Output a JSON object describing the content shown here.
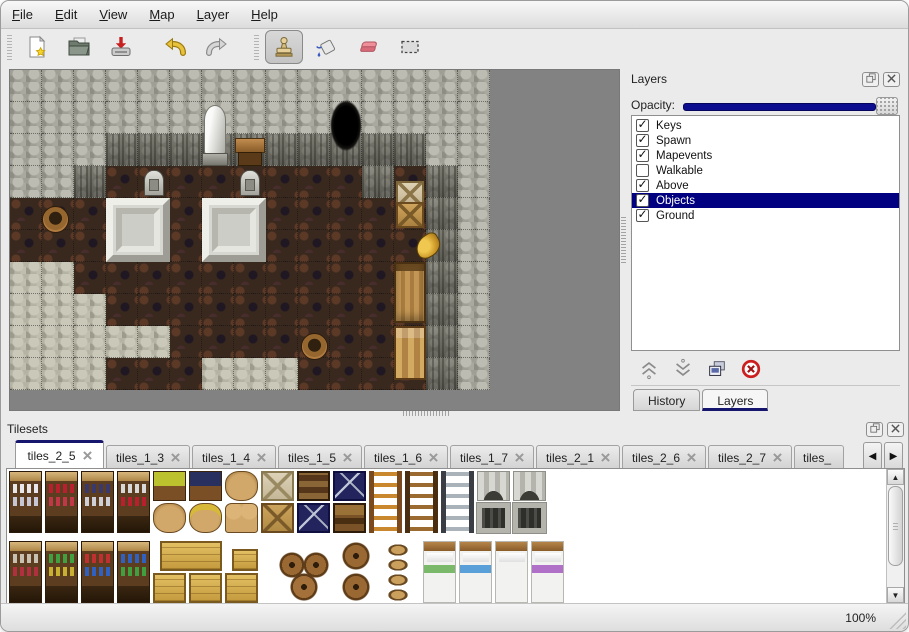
{
  "menu": {
    "items": [
      {
        "label": "File"
      },
      {
        "label": "Edit"
      },
      {
        "label": "View"
      },
      {
        "label": "Map"
      },
      {
        "label": "Layer"
      },
      {
        "label": "Help"
      }
    ]
  },
  "toolbar": {
    "buttons": [
      {
        "name": "new",
        "icon": "new-file-icon"
      },
      {
        "name": "open",
        "icon": "open-folder-icon"
      },
      {
        "name": "save",
        "icon": "save-icon"
      },
      {
        "name": "undo",
        "icon": "undo-icon"
      },
      {
        "name": "redo",
        "icon": "redo-icon"
      },
      {
        "name": "stamp",
        "icon": "stamp-tool-icon",
        "active": true
      },
      {
        "name": "fill",
        "icon": "fill-bucket-icon"
      },
      {
        "name": "eraser",
        "icon": "eraser-icon"
      },
      {
        "name": "select",
        "icon": "rect-select-icon"
      }
    ]
  },
  "layers_panel": {
    "title": "Layers",
    "opacity_label": "Opacity:",
    "opacity_percent": 100,
    "layers": [
      {
        "name": "Keys",
        "checked": true,
        "selected": false
      },
      {
        "name": "Spawn",
        "checked": true,
        "selected": false
      },
      {
        "name": "Mapevents",
        "checked": true,
        "selected": false
      },
      {
        "name": "Walkable",
        "checked": false,
        "selected": false
      },
      {
        "name": "Above",
        "checked": true,
        "selected": false
      },
      {
        "name": "Objects",
        "checked": true,
        "selected": true
      },
      {
        "name": "Ground",
        "checked": true,
        "selected": false
      }
    ],
    "actions": [
      "move-layer-up",
      "move-layer-down",
      "duplicate-layer",
      "delete-layer"
    ],
    "dock_tabs": [
      {
        "label": "History",
        "active": false
      },
      {
        "label": "Layers",
        "active": true
      }
    ]
  },
  "tilesets_panel": {
    "title": "Tilesets",
    "tabs": [
      {
        "label": "tiles_2_5",
        "active": true
      },
      {
        "label": "tiles_1_3"
      },
      {
        "label": "tiles_1_4"
      },
      {
        "label": "tiles_1_5"
      },
      {
        "label": "tiles_1_6"
      },
      {
        "label": "tiles_1_7"
      },
      {
        "label": "tiles_2_1"
      },
      {
        "label": "tiles_2_6"
      },
      {
        "label": "tiles_2_7"
      },
      {
        "label": "tiles_",
        "truncated": true
      }
    ]
  },
  "status": {
    "zoom_label": "100%"
  },
  "map": {
    "tile_size": 32,
    "legend": {
      "W": "rock-wall",
      "D": "rock-wall-dark",
      "F": "wood-floor",
      "R": "rubble-floor"
    },
    "colors": {
      "wall": "#a09f95",
      "wall_dark": "#7d7c72",
      "floor": "#39281e",
      "rubble": "#b5b3a4",
      "backdrop": "#828282",
      "accent": "#000080"
    },
    "grid": [
      "WWWWWWWWWWWWWWW",
      "WWWWWWWWWWWWWWW",
      "WWWDDDDDDDDDDWW",
      "WWDFFFFFFFFDFDW",
      "FFFFFFFFFFFFFDW",
      "FFFFFFFFFFFFFDW",
      "RRFFFFFFFFFFFDW",
      "RRRFFFFFFFFFFDW",
      "RRRRRFFFFFFFFDW",
      "RRRFFFRRRFFFFDW"
    ],
    "objects": [
      {
        "type": "statue",
        "c": 5.9,
        "r": 1,
        "w": 1,
        "h": 2.05
      },
      {
        "type": "table",
        "c": 7,
        "r": 2.05,
        "w": 1,
        "h": 1
      },
      {
        "type": "cave",
        "c": 9.9,
        "r": 0.7,
        "w": 1.2,
        "h": 2.5
      },
      {
        "type": "gravestone",
        "c": 4,
        "r": 3,
        "w": 1,
        "h": 1
      },
      {
        "type": "gravestone",
        "c": 7,
        "r": 3,
        "w": 1,
        "h": 1
      },
      {
        "type": "platform",
        "c": 3,
        "r": 4,
        "w": 2,
        "h": 2
      },
      {
        "type": "platform",
        "c": 6,
        "r": 4,
        "w": 2,
        "h": 2
      },
      {
        "type": "barrel",
        "c": 0.9,
        "r": 4.1,
        "w": 1,
        "h": 1.2
      },
      {
        "type": "crates",
        "c": 12,
        "r": 3.4,
        "w": 1,
        "h": 1.6
      },
      {
        "type": "horn",
        "c": 12.55,
        "r": 5.05,
        "w": 1,
        "h": 1
      },
      {
        "type": "cabinet",
        "c": 12,
        "r": 6,
        "w": 1,
        "h": 1.9
      },
      {
        "type": "desk",
        "c": 12,
        "r": 8,
        "w": 1,
        "h": 1.7
      },
      {
        "type": "barrel",
        "c": 9,
        "r": 8.05,
        "w": 1,
        "h": 1.1
      }
    ]
  },
  "tileset": {
    "cell": 36,
    "row_h": 32,
    "band_gap": 6,
    "sprites": [
      {
        "t": "shelf",
        "v": "dishes",
        "c": 0,
        "r": 0,
        "h": 2
      },
      {
        "t": "shelf",
        "v": "wine",
        "c": 1,
        "r": 0,
        "h": 2
      },
      {
        "t": "shelf",
        "v": "pots",
        "c": 2,
        "r": 0,
        "h": 2
      },
      {
        "t": "shelf",
        "v": "jars",
        "c": 3,
        "r": 0,
        "h": 2
      },
      {
        "t": "planter",
        "v": "yellow",
        "c": 4,
        "r": 0
      },
      {
        "t": "planter",
        "v": "dark",
        "c": 5,
        "r": 0
      },
      {
        "t": "sack",
        "v": "big",
        "c": 6,
        "r": 0
      },
      {
        "t": "cratex",
        "v": "pale",
        "c": 7,
        "r": 0
      },
      {
        "t": "chest",
        "v": "band",
        "c": 8,
        "r": 0
      },
      {
        "t": "cratenavy",
        "v": "z",
        "c": 9,
        "r": 0
      },
      {
        "t": "sack",
        "v": "full",
        "c": 4,
        "r": 1
      },
      {
        "t": "sack",
        "v": "open",
        "c": 5,
        "r": 1
      },
      {
        "t": "sack",
        "v": "pile",
        "c": 6,
        "r": 1
      },
      {
        "t": "cratex",
        "v": "tan",
        "c": 7,
        "r": 1
      },
      {
        "t": "cratenavy",
        "v": "plain",
        "c": 8,
        "r": 1
      },
      {
        "t": "chest",
        "v": "front",
        "c": 9,
        "r": 1
      },
      {
        "t": "ladder",
        "v": "orange",
        "c": 10,
        "r": 0,
        "h": 2
      },
      {
        "t": "ladder",
        "v": "brown",
        "c": 11,
        "r": 0,
        "h": 2
      },
      {
        "t": "ladder",
        "v": "steel",
        "c": 12,
        "r": 0,
        "h": 2
      },
      {
        "t": "arch",
        "v": "l",
        "c": 13,
        "r": 0
      },
      {
        "t": "arch",
        "v": "r",
        "c": 14,
        "r": 0
      },
      {
        "t": "door",
        "v": "l",
        "c": 13,
        "r": 1
      },
      {
        "t": "door",
        "v": "r",
        "c": 14,
        "r": 1
      },
      {
        "t": "shelf",
        "v": "food1",
        "c": 0,
        "r": 2,
        "h": 2
      },
      {
        "t": "shelf",
        "v": "food2",
        "c": 1,
        "r": 2,
        "h": 2
      },
      {
        "t": "shelf",
        "v": "food3",
        "c": 2,
        "r": 2,
        "h": 2
      },
      {
        "t": "shelf",
        "v": "food4",
        "c": 3,
        "r": 2,
        "h": 2
      },
      {
        "t": "cratey",
        "v": "wide",
        "c": 4.2,
        "r": 2,
        "w": 1.8
      },
      {
        "t": "cratey",
        "v": "small",
        "c": 6.2,
        "r": 2.25,
        "w": 0.8,
        "h": 0.75
      },
      {
        "t": "cratey",
        "v": "plain",
        "c": 4,
        "r": 3
      },
      {
        "t": "cratey",
        "v": "plain",
        "c": 5,
        "r": 3
      },
      {
        "t": "cratey",
        "v": "plain",
        "c": 6,
        "r": 3
      },
      {
        "t": "barrels",
        "v": "trio",
        "c": 7.4,
        "r": 2.3,
        "w": 1.7,
        "h": 1.7
      },
      {
        "t": "barrels",
        "v": "stack2",
        "c": 9.2,
        "r": 2,
        "w": 1,
        "h": 2
      },
      {
        "t": "pots",
        "v": "stack4",
        "c": 10.4,
        "r": 2,
        "w": 0.9,
        "h": 2
      },
      {
        "t": "bed",
        "v": "green",
        "c": 11.5,
        "r": 2,
        "h": 2
      },
      {
        "t": "bed",
        "v": "blue",
        "c": 12.5,
        "r": 2,
        "h": 2
      },
      {
        "t": "bed",
        "v": "white",
        "c": 13.5,
        "r": 2,
        "h": 2
      },
      {
        "t": "bed",
        "v": "purple",
        "c": 14.5,
        "r": 2,
        "h": 2
      }
    ]
  }
}
